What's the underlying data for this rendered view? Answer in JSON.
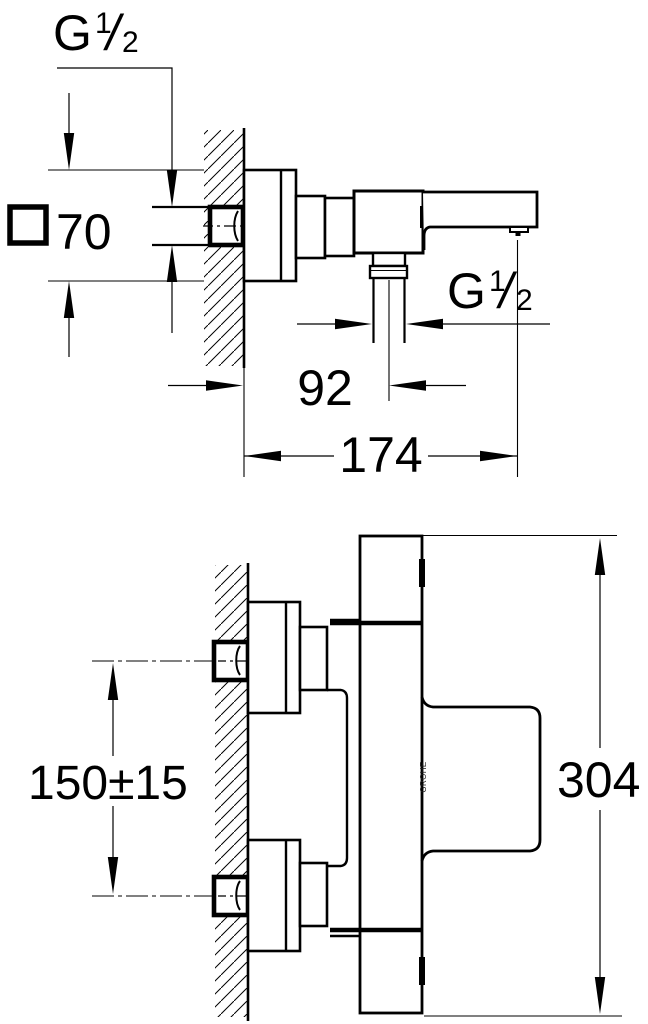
{
  "page": {
    "background": "#ffffff",
    "line_color": "#000000",
    "description": "Technical dimension drawing of a wall-mounted bath/shower mixer tap, two orthographic views"
  },
  "side_view": {
    "inlet_thread_label": {
      "base": "G",
      "numerator": "1",
      "denominator": "2"
    },
    "escutcheon_dim": {
      "symbol": "square-outline",
      "value": "70"
    },
    "shower_thread_label": {
      "base": "G",
      "numerator": "1",
      "denominator": "2"
    },
    "wall_to_shower_outlet": "92",
    "wall_to_spout_outlet": "174"
  },
  "plan_view": {
    "inlet_spacing": "150±15",
    "body_width": "304",
    "brand": "GROHE"
  }
}
